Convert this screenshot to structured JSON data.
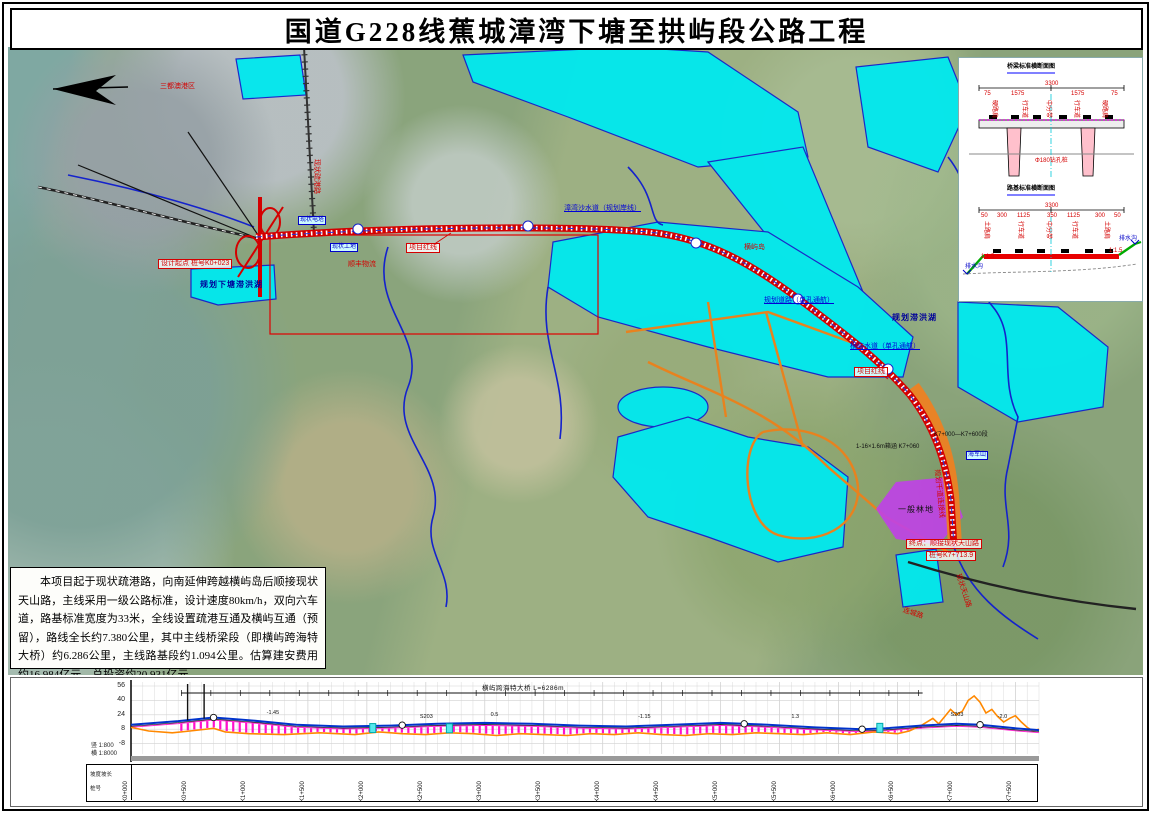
{
  "title": "国道G228线蕉城漳湾下塘至拱屿段公路工程",
  "description": "本项目起于现状疏港路，向南延伸跨越横屿岛后顺接现状天山路，主线采用一级公路标准，设计速度80km/h，双向六车道，路基标准宽度为33米，全线设置疏港互通及横屿互通（预留），路线全长约7.380公里，其中主线桥梁段（即横屿跨海特大桥）约6.286公里，主线路基段约1.094公里。估算建安费用约16.984亿元，总投资约20.931亿元。",
  "colors": {
    "route_red": "#d40000",
    "plan_cyan": "#00e9ef",
    "boundary_blue": "#1422cc",
    "plan_orange": "#e8821e",
    "forest_purple": "#c040e8",
    "profile_magenta": "#ff10cc",
    "profile_ground": "#ff8800",
    "profile_design": "#0033cc"
  },
  "map": {
    "labels": [
      {
        "text": "三都澳港区",
        "x": 152,
        "y": 36,
        "cls": "red",
        "name": "port-area-label"
      },
      {
        "text": "现状疏港路",
        "x": 312,
        "y": 112,
        "cls": "red",
        "rot": 90,
        "name": "shugang-road-label"
      },
      {
        "text": "设计起点 桩号K0+023",
        "x": 150,
        "y": 212,
        "cls": "redbox",
        "name": "route-start-label"
      },
      {
        "text": "规划下塘滞洪湖",
        "x": 192,
        "y": 233,
        "cls": "dkblue",
        "name": "xiatang-lake-label"
      },
      {
        "text": "现状电塔",
        "x": 290,
        "y": 169,
        "cls": "bluebox",
        "name": "power-tower-label"
      },
      {
        "text": "现状工地",
        "x": 322,
        "y": 196,
        "cls": "bluebox",
        "name": "worksite-label"
      },
      {
        "text": "顺丰物流",
        "x": 340,
        "y": 214,
        "cls": "red",
        "name": "logistics-label"
      },
      {
        "text": "项目红线",
        "x": 398,
        "y": 196,
        "cls": "redbox",
        "name": "project-redline-label-1"
      },
      {
        "text": "漳湾沙水道（规划岸线）",
        "x": 556,
        "y": 158,
        "cls": "blueul",
        "name": "waterway-label-1"
      },
      {
        "text": "横屿岛",
        "x": 736,
        "y": 197,
        "cls": "red",
        "name": "hengyu-island-label"
      },
      {
        "text": "规划道路（单孔通航）",
        "x": 756,
        "y": 250,
        "cls": "blueul",
        "name": "plan-road-nav-label"
      },
      {
        "text": "规划滞洪湖",
        "x": 884,
        "y": 266,
        "cls": "dkblue",
        "name": "plan-lake-label"
      },
      {
        "text": "横屿水道（单孔通航）",
        "x": 842,
        "y": 296,
        "cls": "blueul",
        "name": "waterway-label-2"
      },
      {
        "text": "项目红线",
        "x": 846,
        "y": 320,
        "cls": "redbox",
        "name": "project-redline-label-2"
      },
      {
        "text": "1-16×1.6m箱涵 K7+060",
        "x": 848,
        "y": 397,
        "cls": "blk",
        "name": "culvert-label"
      },
      {
        "text": "K7+000—K7+600段",
        "x": 926,
        "y": 385,
        "cls": "blk",
        "name": "segment-label"
      },
      {
        "text": "海军山",
        "x": 958,
        "y": 404,
        "cls": "bluebox",
        "name": "haijun-hill-label"
      },
      {
        "text": "规划干道连接线",
        "x": 932,
        "y": 422,
        "cls": "red",
        "rot": 84,
        "name": "plan-trunk-label"
      },
      {
        "text": "一般林地",
        "x": 890,
        "y": 458,
        "cls": "blk8",
        "name": "forest-land-label"
      },
      {
        "text": "终点：顺接现状天山路",
        "x": 898,
        "y": 492,
        "cls": "redbox",
        "name": "route-end-label"
      },
      {
        "text": "桩号K7+713.9",
        "x": 918,
        "y": 504,
        "cls": "redbox",
        "name": "route-end-station-label"
      },
      {
        "text": "现状天山路",
        "x": 953,
        "y": 526,
        "cls": "red",
        "rot": 72,
        "name": "tianshan-road-label"
      },
      {
        "text": "连城路",
        "x": 896,
        "y": 560,
        "cls": "red",
        "rot": 18,
        "name": "liancheng-road-label"
      }
    ]
  },
  "detail_panel": {
    "labels": [
      {
        "text": "桥梁标准横断面图",
        "x": 48,
        "y": 6,
        "cls": "dtitle",
        "name": "bridge-section-title"
      },
      {
        "text": "3300",
        "x": 86,
        "y": 23,
        "cls": "dim"
      },
      {
        "text": "75",
        "x": 25,
        "y": 33,
        "cls": "dim"
      },
      {
        "text": "1575",
        "x": 52,
        "y": 33,
        "cls": "dim"
      },
      {
        "text": "1575",
        "x": 112,
        "y": 33,
        "cls": "dim"
      },
      {
        "text": "75",
        "x": 152,
        "y": 33,
        "cls": "dim"
      },
      {
        "text": "硬路肩",
        "x": 38,
        "y": 42,
        "cls": "dimv"
      },
      {
        "text": "行车道",
        "x": 68,
        "y": 42,
        "cls": "dimv"
      },
      {
        "text": "中分带",
        "x": 92,
        "y": 42,
        "cls": "dimv"
      },
      {
        "text": "行车道",
        "x": 120,
        "y": 42,
        "cls": "dimv"
      },
      {
        "text": "硬路肩",
        "x": 148,
        "y": 42,
        "cls": "dimv"
      },
      {
        "text": "Φ180钻孔桩",
        "x": 76,
        "y": 100,
        "cls": "dim"
      },
      {
        "text": "路基标准横断面图",
        "x": 48,
        "y": 128,
        "cls": "dtitle",
        "name": "roadbed-section-title"
      },
      {
        "text": "3300",
        "x": 86,
        "y": 145,
        "cls": "dim"
      },
      {
        "text": "50",
        "x": 22,
        "y": 155,
        "cls": "dim"
      },
      {
        "text": "300",
        "x": 38,
        "y": 155,
        "cls": "dim"
      },
      {
        "text": "1125",
        "x": 58,
        "y": 155,
        "cls": "dim"
      },
      {
        "text": "350",
        "x": 88,
        "y": 155,
        "cls": "dim"
      },
      {
        "text": "1125",
        "x": 108,
        "y": 155,
        "cls": "dim"
      },
      {
        "text": "300",
        "x": 136,
        "y": 155,
        "cls": "dim"
      },
      {
        "text": "50",
        "x": 155,
        "y": 155,
        "cls": "dim"
      },
      {
        "text": "土路肩",
        "x": 30,
        "y": 163,
        "cls": "dimv"
      },
      {
        "text": "行车道",
        "x": 64,
        "y": 163,
        "cls": "dimv"
      },
      {
        "text": "中分带",
        "x": 92,
        "y": 163,
        "cls": "dimv"
      },
      {
        "text": "行车道",
        "x": 118,
        "y": 163,
        "cls": "dimv"
      },
      {
        "text": "土路肩",
        "x": 150,
        "y": 163,
        "cls": "dimv"
      },
      {
        "text": "1:1.5",
        "x": 22,
        "y": 196,
        "cls": "dim"
      },
      {
        "text": "1:1.5",
        "x": 150,
        "y": 190,
        "cls": "dim"
      },
      {
        "text": "排水沟",
        "x": 6,
        "y": 206,
        "cls": "dimb"
      },
      {
        "text": "排水沟",
        "x": 160,
        "y": 178,
        "cls": "dimb"
      }
    ]
  },
  "chart_data": {
    "type": "line",
    "title": "路线纵断面",
    "yticks": [
      56,
      40,
      24,
      8,
      -8
    ],
    "ylim": [
      -24,
      60
    ],
    "x_stations": [
      "K0+000",
      "K0+500",
      "K1+000",
      "K1+500",
      "K2+000",
      "K2+500",
      "K3+000",
      "K3+500",
      "K4+000",
      "K4+500",
      "K5+000",
      "K5+500",
      "K6+000",
      "K6+500",
      "K7+000",
      "K7+500"
    ],
    "station_step_m": 500,
    "length_m": 7700,
    "series": [
      {
        "name": "设计线",
        "color": "#0033cc",
        "x": [
          0,
          400,
          700,
          1000,
          1400,
          1800,
          2200,
          2600,
          3000,
          3400,
          3800,
          4200,
          4600,
          5000,
          5400,
          5800,
          6200,
          6400,
          6700,
          7000,
          7200,
          7500,
          7700
        ],
        "y": [
          13,
          17,
          21,
          18,
          13,
          11,
          12,
          14,
          15,
          14,
          12,
          11,
          13,
          15,
          13,
          10,
          8,
          9,
          12,
          14,
          13,
          9,
          7
        ]
      },
      {
        "name": "地面线",
        "color": "#ff8800",
        "x": [
          0,
          150,
          350,
          500,
          700,
          800,
          1000,
          1300,
          1600,
          1900,
          2100,
          2300,
          2500,
          2700,
          2900,
          3100,
          3300,
          3500,
          3700,
          3900,
          4100,
          4300,
          4500,
          4700,
          4900,
          5100,
          5300,
          5500,
          5700,
          5900,
          6100,
          6300,
          6500,
          6600,
          6700,
          6800,
          6850,
          6900,
          6950,
          7000,
          7050,
          7100,
          7150,
          7200,
          7250,
          7300,
          7350,
          7400,
          7450,
          7500,
          7550,
          7600,
          7650,
          7700
        ],
        "y": [
          10,
          6,
          4,
          6,
          9,
          5,
          3,
          2,
          4,
          2,
          5,
          3,
          2,
          4,
          3,
          1,
          3,
          2,
          1,
          3,
          2,
          4,
          2,
          1,
          3,
          2,
          4,
          3,
          2,
          4,
          2,
          5,
          3,
          6,
          12,
          20,
          14,
          22,
          30,
          24,
          28,
          40,
          45,
          38,
          26,
          30,
          22,
          16,
          20,
          23,
          16,
          10,
          6,
          8
        ]
      }
    ],
    "bridge_extent": {
      "from_m": 427,
      "to_m": 6713,
      "label": "横屿跨海特大桥 L=6286m"
    },
    "curve_points_m": [
      700,
      2300,
      5200,
      6200,
      7200
    ],
    "annotations": [
      {
        "s": 1150,
        "e": 20,
        "text": "-1.45"
      },
      {
        "s": 2450,
        "e": 16,
        "text": "S203"
      },
      {
        "s": 3050,
        "e": 18,
        "text": "0.5"
      },
      {
        "s": 4300,
        "e": 16,
        "text": "-1.15"
      },
      {
        "s": 5600,
        "e": 16,
        "text": "1.3"
      },
      {
        "s": 6950,
        "e": 18,
        "text": "S203"
      },
      {
        "s": 7350,
        "e": 16,
        "text": "-2.0"
      }
    ],
    "scales": {
      "v": "竖 1:800",
      "h": "横 1:8000"
    },
    "side_rows": [
      "坡度坡长",
      "桩号"
    ],
    "legend_position": "none",
    "grid": true
  }
}
